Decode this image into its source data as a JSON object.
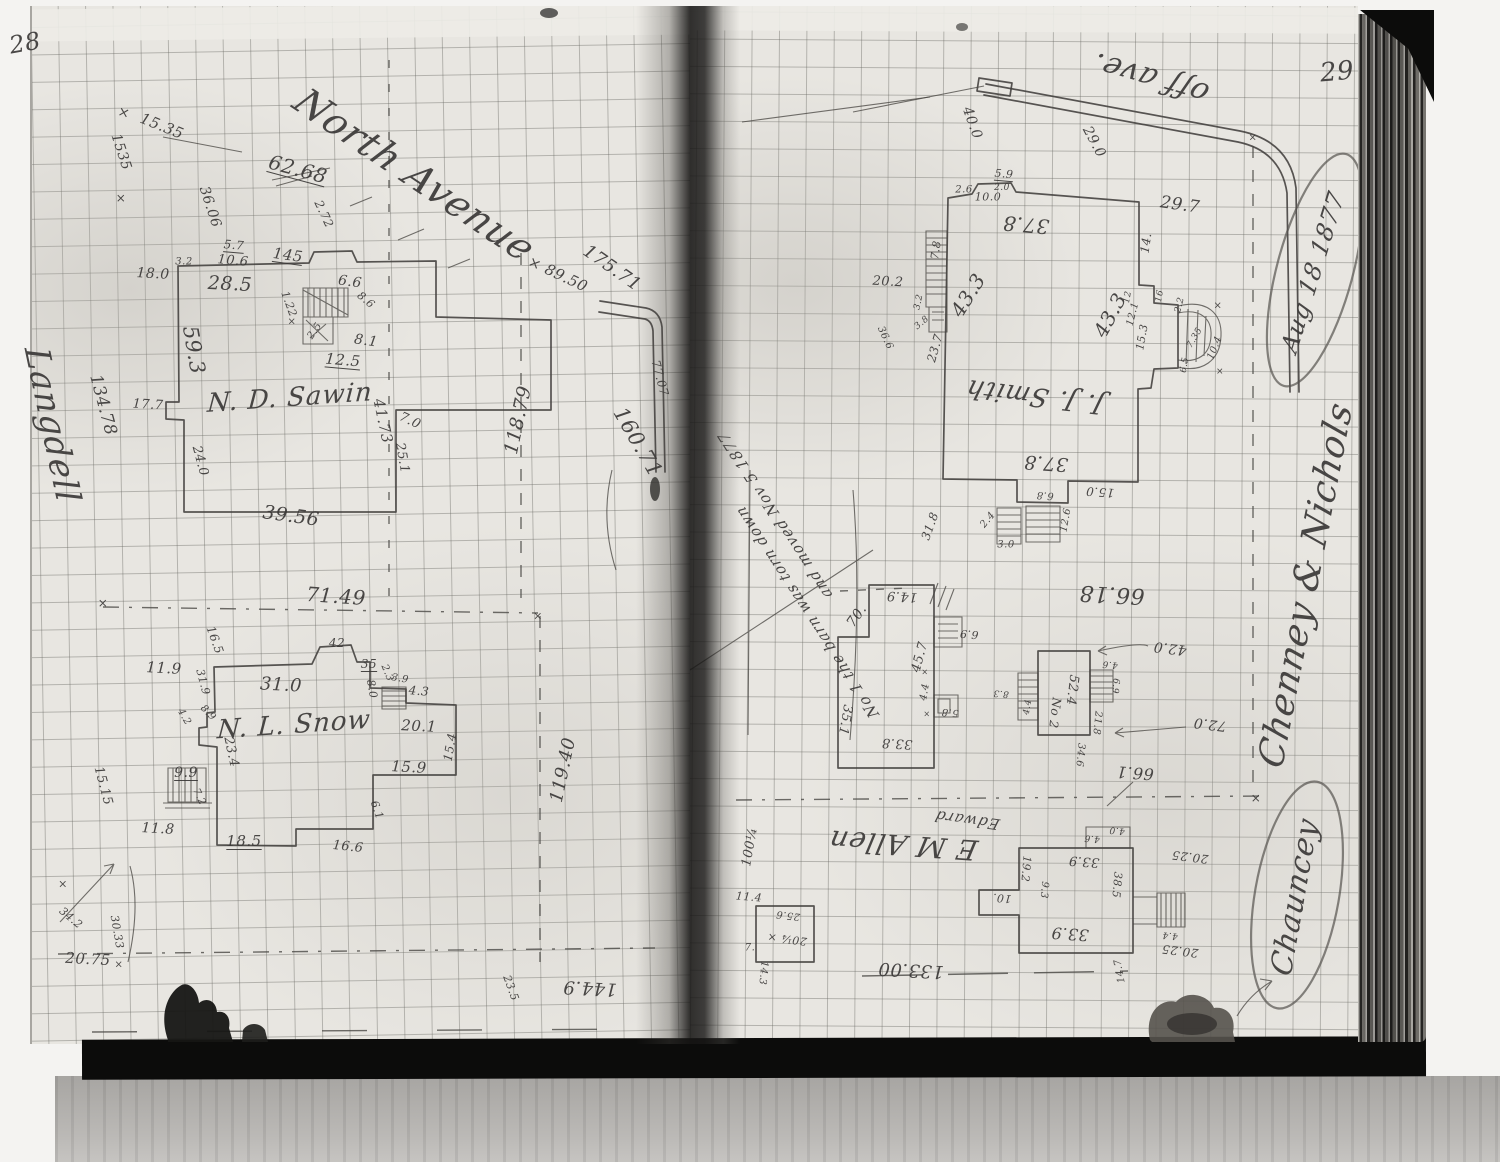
{
  "document": {
    "left_page_number": "28",
    "right_page_number": "29",
    "date_circled": "Aug 18 1877",
    "note_date": "Nov 5 1877"
  },
  "pages": {
    "left": {
      "page_number": "28",
      "annotations": [
        {
          "t": "28",
          "x": 25,
          "y": 43,
          "s": 24,
          "r": -10
        },
        {
          "t": "×",
          "x": 124,
          "y": 113,
          "s": 14,
          "r": 15
        },
        {
          "t": "15.35",
          "x": 162,
          "y": 126,
          "s": 15,
          "r": 22
        },
        {
          "t": "1535",
          "x": 121,
          "y": 152,
          "s": 14,
          "r": 72
        },
        {
          "t": "×",
          "x": 121,
          "y": 198,
          "s": 12
        },
        {
          "t": "62.68",
          "x": 298,
          "y": 169,
          "s": 20,
          "r": 15,
          "u": 1
        },
        {
          "t": "North Avenue",
          "x": 415,
          "y": 175,
          "s": 38,
          "r": 34,
          "k": "cur"
        },
        {
          "t": "36.06",
          "x": 210,
          "y": 207,
          "s": 14,
          "r": 72
        },
        {
          "t": "2.72",
          "x": 324,
          "y": 214,
          "s": 12,
          "r": 65
        },
        {
          "t": "5.7",
          "x": 234,
          "y": 245,
          "s": 12,
          "r": 5,
          "u": 1
        },
        {
          "t": "10.6",
          "x": 233,
          "y": 261,
          "s": 13,
          "r": 5
        },
        {
          "t": "3.2",
          "x": 184,
          "y": 262,
          "s": 10
        },
        {
          "t": "145",
          "x": 288,
          "y": 255,
          "s": 15,
          "r": 8,
          "u": 1
        },
        {
          "t": "18.0",
          "x": 153,
          "y": 274,
          "s": 14,
          "r": 3
        },
        {
          "t": "28.5",
          "x": 230,
          "y": 284,
          "s": 19,
          "r": 3
        },
        {
          "t": "6.6",
          "x": 350,
          "y": 282,
          "s": 14,
          "r": 8
        },
        {
          "t": "1.22",
          "x": 289,
          "y": 304,
          "s": 11,
          "r": 70
        },
        {
          "t": "×",
          "x": 292,
          "y": 322,
          "s": 10
        },
        {
          "t": "8.6",
          "x": 366,
          "y": 300,
          "s": 11,
          "r": 40
        },
        {
          "t": "59.3",
          "x": 194,
          "y": 350,
          "s": 21,
          "r": 80
        },
        {
          "t": "2.5",
          "x": 315,
          "y": 331,
          "s": 10,
          "r": -55
        },
        {
          "t": "8.1",
          "x": 366,
          "y": 341,
          "s": 14,
          "r": 8
        },
        {
          "t": "12.5",
          "x": 343,
          "y": 360,
          "s": 15,
          "r": 5,
          "u": 1
        },
        {
          "t": "N. D. Sawin",
          "x": 290,
          "y": 398,
          "s": 26,
          "r": -4,
          "k": "cur"
        },
        {
          "t": "17.7",
          "x": 148,
          "y": 405,
          "s": 13,
          "r": 3
        },
        {
          "t": "41.73",
          "x": 383,
          "y": 421,
          "s": 15,
          "r": 78
        },
        {
          "t": "7.0",
          "x": 410,
          "y": 421,
          "s": 13,
          "r": 25
        },
        {
          "t": "25.1",
          "x": 402,
          "y": 458,
          "s": 13,
          "r": 80
        },
        {
          "t": "24.0",
          "x": 200,
          "y": 461,
          "s": 13,
          "r": 75
        },
        {
          "t": "39.56",
          "x": 291,
          "y": 516,
          "s": 19,
          "r": 8
        },
        {
          "t": "118.79",
          "x": 518,
          "y": 420,
          "s": 19,
          "r": -78
        },
        {
          "t": "× 89.50",
          "x": 558,
          "y": 274,
          "s": 15,
          "r": 25
        },
        {
          "t": "175.71",
          "x": 612,
          "y": 268,
          "s": 18,
          "r": 35
        },
        {
          "t": "160.71",
          "x": 638,
          "y": 442,
          "s": 21,
          "r": 60
        },
        {
          "t": "77.07",
          "x": 660,
          "y": 378,
          "s": 12,
          "r": 75
        },
        {
          "t": "134.78",
          "x": 103,
          "y": 405,
          "s": 17,
          "r": 75
        },
        {
          "t": "Langdell",
          "x": 52,
          "y": 425,
          "s": 34,
          "r": 78,
          "k": "cur"
        },
        {
          "t": "71.49",
          "x": 336,
          "y": 596,
          "s": 20,
          "r": 4
        },
        {
          "t": "×",
          "x": 103,
          "y": 603,
          "s": 12
        },
        {
          "t": "×",
          "x": 538,
          "y": 616,
          "s": 11
        },
        {
          "t": "11.9",
          "x": 164,
          "y": 668,
          "s": 15,
          "r": 3
        },
        {
          "t": "16.5",
          "x": 215,
          "y": 640,
          "s": 12,
          "r": 70
        },
        {
          "t": "42",
          "x": 337,
          "y": 643,
          "s": 12
        },
        {
          "t": "35",
          "x": 369,
          "y": 664,
          "s": 12,
          "u": 1
        },
        {
          "t": "2.3",
          "x": 387,
          "y": 673,
          "s": 10,
          "r": 68
        },
        {
          "t": "3.9",
          "x": 400,
          "y": 679,
          "s": 10,
          "r": 10
        },
        {
          "t": "8.0",
          "x": 372,
          "y": 689,
          "s": 11,
          "r": 80
        },
        {
          "t": "4.3",
          "x": 419,
          "y": 691,
          "s": 12,
          "r": 5
        },
        {
          "t": "31.0",
          "x": 281,
          "y": 685,
          "s": 18,
          "r": 3
        },
        {
          "t": "31.9",
          "x": 203,
          "y": 682,
          "s": 11,
          "r": 75
        },
        {
          "t": "4.2",
          "x": 184,
          "y": 717,
          "s": 10,
          "r": 60
        },
        {
          "t": "8.9",
          "x": 208,
          "y": 713,
          "s": 10,
          "r": 45
        },
        {
          "t": "N. L. Snow",
          "x": 294,
          "y": 725,
          "s": 26,
          "r": -4,
          "k": "cur"
        },
        {
          "t": "23.4",
          "x": 231,
          "y": 752,
          "s": 13,
          "r": 78
        },
        {
          "t": "20.1",
          "x": 419,
          "y": 726,
          "s": 15,
          "r": 3
        },
        {
          "t": "15.4",
          "x": 450,
          "y": 747,
          "s": 12,
          "r": -80
        },
        {
          "t": "15.9",
          "x": 409,
          "y": 767,
          "s": 15,
          "r": 3
        },
        {
          "t": "9.9",
          "x": 186,
          "y": 773,
          "s": 14,
          "u": 1
        },
        {
          "t": "7.2",
          "x": 199,
          "y": 797,
          "s": 10,
          "r": 65
        },
        {
          "t": "6.1",
          "x": 377,
          "y": 810,
          "s": 11,
          "r": 70
        },
        {
          "t": "11.8",
          "x": 158,
          "y": 829,
          "s": 14,
          "r": 3
        },
        {
          "t": "18.5",
          "x": 244,
          "y": 841,
          "s": 15,
          "u": 1
        },
        {
          "t": "16.6",
          "x": 348,
          "y": 847,
          "s": 13,
          "r": 6
        },
        {
          "t": "119.40",
          "x": 563,
          "y": 770,
          "s": 18,
          "r": -78
        },
        {
          "t": "15.15",
          "x": 103,
          "y": 786,
          "s": 13,
          "r": 75
        },
        {
          "t": "×",
          "x": 63,
          "y": 884,
          "s": 11
        },
        {
          "t": "34.2",
          "x": 71,
          "y": 918,
          "s": 11,
          "r": 40
        },
        {
          "t": "30.33",
          "x": 117,
          "y": 932,
          "s": 11,
          "r": 80
        },
        {
          "t": "20.75",
          "x": 88,
          "y": 959,
          "s": 15,
          "r": 3
        },
        {
          "t": "×",
          "x": 119,
          "y": 965,
          "s": 10
        },
        {
          "t": "23.5",
          "x": 511,
          "y": 988,
          "s": 11,
          "r": 70
        },
        {
          "t": "144.9",
          "x": 590,
          "y": 988,
          "s": 18,
          "r": 183
        }
      ]
    },
    "right": {
      "page_number": "29",
      "annotations": [
        {
          "t": "29",
          "x": 1337,
          "y": 72,
          "s": 26,
          "r": -5
        },
        {
          "t": "off ave.",
          "x": 1150,
          "y": 78,
          "s": 30,
          "r": 196,
          "k": "cur"
        },
        {
          "t": "40.0",
          "x": 972,
          "y": 123,
          "s": 14,
          "r": 70
        },
        {
          "t": "29.0",
          "x": 1094,
          "y": 142,
          "s": 14,
          "r": 62
        },
        {
          "t": "29.7",
          "x": 1180,
          "y": 205,
          "s": 17,
          "r": 8
        },
        {
          "t": "5.9",
          "x": 1004,
          "y": 174,
          "s": 11,
          "r": 5,
          "u": 1
        },
        {
          "t": "2.0",
          "x": 1002,
          "y": 188,
          "s": 9
        },
        {
          "t": "2.6",
          "x": 964,
          "y": 190,
          "s": 10
        },
        {
          "t": "10.0",
          "x": 988,
          "y": 197,
          "s": 11
        },
        {
          "t": "37.8",
          "x": 1026,
          "y": 225,
          "s": 20,
          "r": 185
        },
        {
          "t": "14.",
          "x": 1146,
          "y": 243,
          "s": 12,
          "r": -82
        },
        {
          "t": "7.8",
          "x": 936,
          "y": 250,
          "s": 11,
          "r": -82
        },
        {
          "t": "20.2",
          "x": 888,
          "y": 282,
          "s": 13,
          "r": 3
        },
        {
          "t": "43.3",
          "x": 968,
          "y": 295,
          "s": 20,
          "r": -58
        },
        {
          "t": "43.3",
          "x": 1110,
          "y": 315,
          "s": 20,
          "r": -62
        },
        {
          "t": "3.2",
          "x": 919,
          "y": 302,
          "s": 9,
          "r": -78
        },
        {
          "t": "3.8",
          "x": 922,
          "y": 323,
          "s": 9,
          "r": -40
        },
        {
          "t": "23.7",
          "x": 935,
          "y": 348,
          "s": 12,
          "r": -74
        },
        {
          "t": "36.6",
          "x": 885,
          "y": 338,
          "s": 10,
          "r": 65
        },
        {
          "t": "12",
          "x": 1128,
          "y": 297,
          "s": 9,
          "r": -80
        },
        {
          "t": "16",
          "x": 1160,
          "y": 296,
          "s": 9,
          "r": -80
        },
        {
          "t": "12.1",
          "x": 1133,
          "y": 314,
          "s": 10,
          "r": -76
        },
        {
          "t": "15.3",
          "x": 1142,
          "y": 337,
          "s": 11,
          "r": -80
        },
        {
          "t": "2.2",
          "x": 1180,
          "y": 305,
          "s": 9,
          "r": -76
        },
        {
          "t": "7.35",
          "x": 1195,
          "y": 338,
          "s": 9,
          "r": -60
        },
        {
          "t": "×",
          "x": 1218,
          "y": 306,
          "s": 10
        },
        {
          "t": "10.4",
          "x": 1215,
          "y": 348,
          "s": 10,
          "r": -68
        },
        {
          "t": "×",
          "x": 1220,
          "y": 372,
          "s": 9
        },
        {
          "t": "6.5",
          "x": 1185,
          "y": 365,
          "s": 9,
          "r": -80
        },
        {
          "t": "J. J. Smith",
          "x": 1035,
          "y": 396,
          "s": 26,
          "r": 187,
          "k": "cur"
        },
        {
          "t": "37.8",
          "x": 1046,
          "y": 463,
          "s": 19,
          "r": 184
        },
        {
          "t": "15.0",
          "x": 1100,
          "y": 492,
          "s": 12,
          "r": 184
        },
        {
          "t": "6.8",
          "x": 1045,
          "y": 495,
          "s": 10,
          "r": 184
        },
        {
          "t": "2.4",
          "x": 988,
          "y": 520,
          "s": 10,
          "r": -50
        },
        {
          "t": "3.0",
          "x": 1006,
          "y": 545,
          "s": 10
        },
        {
          "t": "12.6",
          "x": 1066,
          "y": 520,
          "s": 10,
          "r": -80
        },
        {
          "t": "31.8",
          "x": 930,
          "y": 526,
          "s": 12,
          "r": -70
        },
        {
          "t": "14.9",
          "x": 902,
          "y": 596,
          "s": 13,
          "r": 183
        },
        {
          "t": "70.",
          "x": 857,
          "y": 616,
          "s": 14,
          "r": -55
        },
        {
          "t": "45.7",
          "x": 920,
          "y": 657,
          "s": 13,
          "r": -75
        },
        {
          "t": "66.18",
          "x": 1112,
          "y": 594,
          "s": 22,
          "r": 183
        },
        {
          "t": "6.9",
          "x": 969,
          "y": 634,
          "s": 11,
          "r": 185
        },
        {
          "t": "No 1 the barn was torn down",
          "x": 807,
          "y": 612,
          "s": 15,
          "r": 237,
          "k": "cur"
        },
        {
          "t": "and moved Nov 5 1877",
          "x": 775,
          "y": 515,
          "s": 15,
          "r": 237,
          "k": "cur"
        },
        {
          "t": "×",
          "x": 925,
          "y": 672,
          "s": 8
        },
        {
          "t": "4.4",
          "x": 925,
          "y": 692,
          "s": 10,
          "r": -80
        },
        {
          "t": "×",
          "x": 927,
          "y": 714,
          "s": 8
        },
        {
          "t": "5.8",
          "x": 950,
          "y": 712,
          "s": 10,
          "r": 185
        },
        {
          "t": "35.1",
          "x": 845,
          "y": 720,
          "s": 13,
          "r": 100
        },
        {
          "t": "33.8",
          "x": 897,
          "y": 743,
          "s": 13,
          "r": 183
        },
        {
          "t": "42.0",
          "x": 1170,
          "y": 648,
          "s": 14,
          "r": 187
        },
        {
          "t": "72.0",
          "x": 1210,
          "y": 724,
          "s": 14,
          "r": 187
        },
        {
          "t": "66.1",
          "x": 1135,
          "y": 773,
          "s": 16,
          "r": 184
        },
        {
          "t": "52.4",
          "x": 1072,
          "y": 690,
          "s": 13,
          "r": 97
        },
        {
          "t": "No 2",
          "x": 1055,
          "y": 713,
          "s": 12,
          "r": 97
        },
        {
          "t": "21.8",
          "x": 1097,
          "y": 723,
          "s": 10,
          "r": 95
        },
        {
          "t": "34.6",
          "x": 1080,
          "y": 755,
          "s": 10,
          "r": 95
        },
        {
          "t": "4.6",
          "x": 1110,
          "y": 664,
          "s": 9,
          "r": 185
        },
        {
          "t": "8.3",
          "x": 1001,
          "y": 693,
          "s": 9,
          "r": 185
        },
        {
          "t": "4.4",
          "x": 1028,
          "y": 707,
          "s": 9,
          "r": -80
        },
        {
          "t": "6.9",
          "x": 1115,
          "y": 686,
          "s": 9,
          "r": 95
        },
        {
          "t": "×",
          "x": 1253,
          "y": 138,
          "s": 10
        },
        {
          "t": "×",
          "x": 1256,
          "y": 798,
          "s": 12
        },
        {
          "t": "E M Allen",
          "x": 903,
          "y": 845,
          "s": 28,
          "r": 184,
          "k": "cur"
        },
        {
          "t": "Edward",
          "x": 967,
          "y": 820,
          "s": 15,
          "r": 188,
          "k": "cur"
        },
        {
          "t": "133.00",
          "x": 911,
          "y": 970,
          "s": 18,
          "r": 183
        },
        {
          "t": "33.9",
          "x": 1084,
          "y": 861,
          "s": 13,
          "r": 184
        },
        {
          "t": "33.9",
          "x": 1070,
          "y": 934,
          "s": 16,
          "r": 184
        },
        {
          "t": "19.2",
          "x": 1026,
          "y": 869,
          "s": 11,
          "r": 95
        },
        {
          "t": "10.",
          "x": 1002,
          "y": 898,
          "s": 11,
          "r": 185
        },
        {
          "t": "9.3",
          "x": 1044,
          "y": 890,
          "s": 10,
          "r": 95
        },
        {
          "t": "38.5",
          "x": 1117,
          "y": 885,
          "s": 11,
          "r": 95
        },
        {
          "t": "4.0",
          "x": 1117,
          "y": 830,
          "s": 9,
          "r": 185
        },
        {
          "t": "4.6",
          "x": 1092,
          "y": 838,
          "s": 9,
          "r": 185
        },
        {
          "t": "4.4",
          "x": 1170,
          "y": 935,
          "s": 9,
          "r": 185
        },
        {
          "t": "20.25",
          "x": 1190,
          "y": 857,
          "s": 12,
          "r": 187
        },
        {
          "t": "20.25",
          "x": 1180,
          "y": 951,
          "s": 12,
          "r": 187
        },
        {
          "t": "14.7",
          "x": 1120,
          "y": 971,
          "s": 10,
          "r": -100
        },
        {
          "t": "100¼",
          "x": 750,
          "y": 847,
          "s": 13,
          "r": -80
        },
        {
          "t": "11.4",
          "x": 749,
          "y": 897,
          "s": 11,
          "r": 5
        },
        {
          "t": "20¼ ×",
          "x": 787,
          "y": 939,
          "s": 11,
          "r": 187
        },
        {
          "t": "25.6",
          "x": 788,
          "y": 915,
          "s": 10,
          "r": 187
        },
        {
          "t": "7.",
          "x": 750,
          "y": 948,
          "s": 10
        },
        {
          "t": "14.3",
          "x": 763,
          "y": 973,
          "s": 10,
          "r": 95
        },
        {
          "t": "Aug 18 1877",
          "x": 1313,
          "y": 272,
          "s": 24,
          "r": -73,
          "k": "cur"
        },
        {
          "t": "Chenney & Nichols",
          "x": 1306,
          "y": 585,
          "s": 36,
          "r": -79,
          "k": "cur"
        },
        {
          "t": "Chauncey",
          "x": 1295,
          "y": 897,
          "s": 30,
          "r": -80,
          "k": "cur"
        }
      ]
    }
  }
}
